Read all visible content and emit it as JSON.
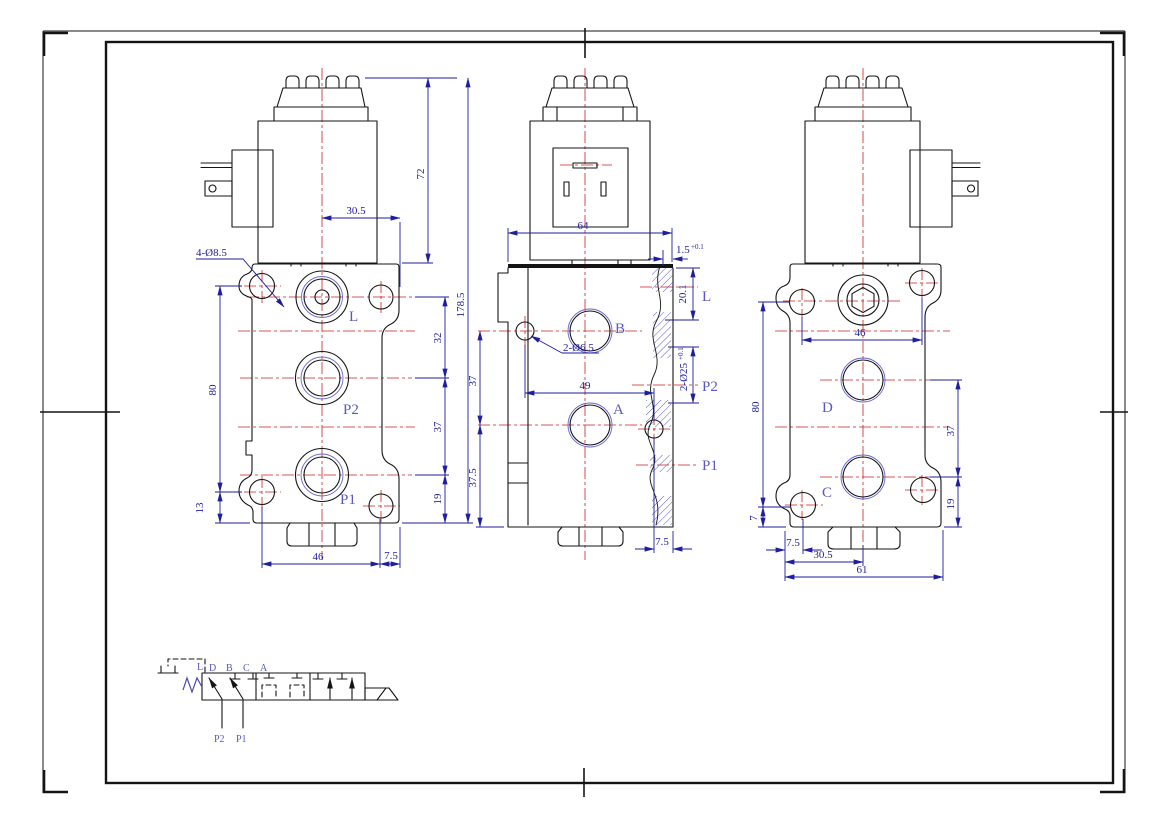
{
  "colors": {
    "linework": "#141414",
    "dimension": "#1e1e9e",
    "port_label": "#5858be",
    "centerline": "#cc2020",
    "hatch": "#5b5bc8"
  },
  "views": {
    "left": {
      "ports": {
        "l": "L",
        "p2": "P2",
        "p1": "P1"
      },
      "dims": {
        "coil_h": "72",
        "offset": "30.5",
        "bolt_holes": "4-Ø8.5",
        "total_h": "178.5",
        "l_p2": "32",
        "p2_p1": "37",
        "p1_base": "19",
        "span": "80",
        "base": "13",
        "width": "46",
        "edge": "7.5"
      }
    },
    "front": {
      "ports": {
        "b": "B",
        "a": "A",
        "l": "L",
        "p2": "P2",
        "p1": "P1"
      },
      "dims": {
        "width": "64",
        "step": "1.5",
        "step_tol": "+0.1",
        "depth": "20.1",
        "pilot_holes": "2-Ø6.5",
        "hole_span": "49",
        "b_a": "37",
        "a_base": "37.5",
        "bore": "2-Ø25",
        "bore_tol": "+0.1",
        "edge": "7.5"
      }
    },
    "right": {
      "ports": {
        "d": "D",
        "c": "C"
      },
      "dims": {
        "top_span": "46",
        "span": "80",
        "base": "7",
        "d_c": "37",
        "c_base": "19",
        "edge": "7.5",
        "center": "30.5",
        "width": "61"
      }
    }
  },
  "schematic": {
    "pilot": "L",
    "top": [
      "D",
      "B",
      "C",
      "A"
    ],
    "bottom": [
      "P2",
      "P1"
    ]
  }
}
